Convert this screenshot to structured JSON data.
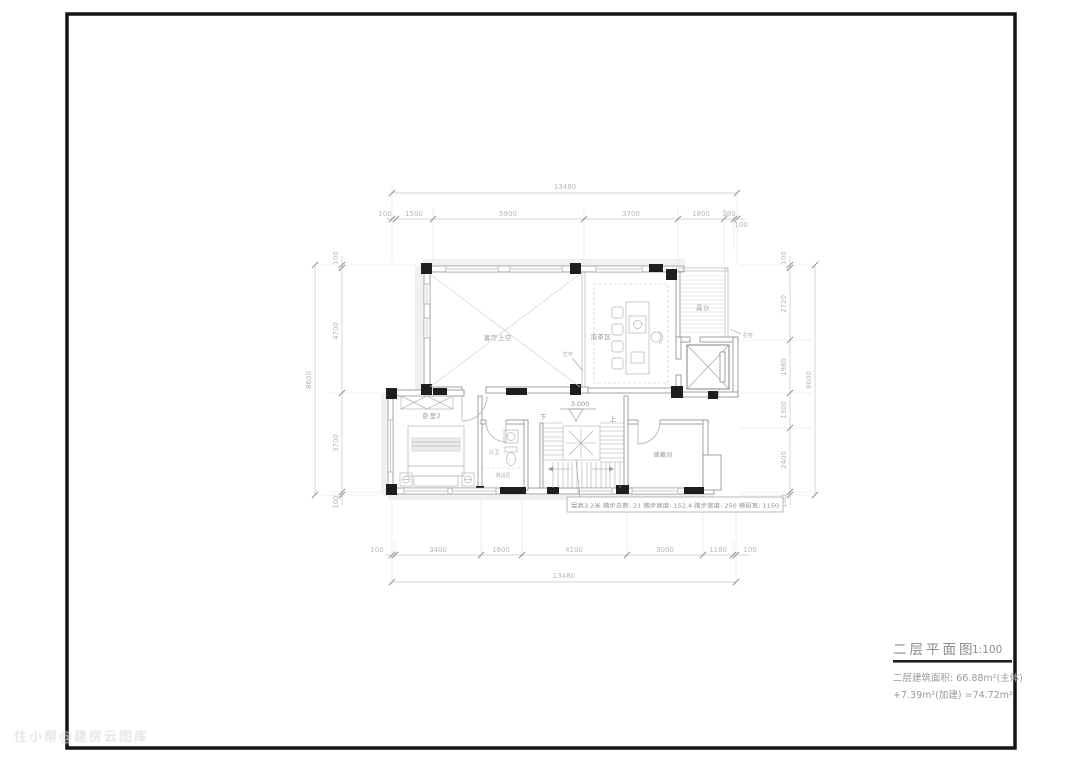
{
  "drawing": {
    "title": "二层平面图",
    "scale": "1:100",
    "area_line1": "二层建筑面积: 66.88m²(主体)",
    "area_line2": "+7.39m²(加建) =74.72m²"
  },
  "watermark": "住小帮@建房云图库",
  "rooms": {
    "living_void": "客厅上空",
    "tea_area": "泡茶区",
    "terrace": "露台",
    "bedroom2": "卧室2",
    "bathroom": "公卫",
    "shower": "淋浴区",
    "storage": "储藏间"
  },
  "labels": {
    "railing": "栏杆",
    "down": "下",
    "up": "上",
    "elevation": "3.000",
    "stair_note": "层高3.2米 踏步总数: 21 踏步高度: 152.4 踏步宽度: 250 梯段宽: 1150"
  },
  "dims": {
    "top_total": "13480",
    "top_segments": [
      "100",
      "1500",
      "5900",
      "3700",
      "1800",
      "380",
      "100"
    ],
    "bottom_total": "13480",
    "bottom_segments": [
      "100",
      "3400",
      "1600",
      "4100",
      "3000",
      "1180",
      "100"
    ],
    "left_total": "8600",
    "left_segments": [
      "100",
      "4700",
      "3700",
      "100"
    ],
    "right_total": "8600",
    "right_segments": [
      "100",
      "2720",
      "1980",
      "1300",
      "2400",
      "100"
    ]
  }
}
